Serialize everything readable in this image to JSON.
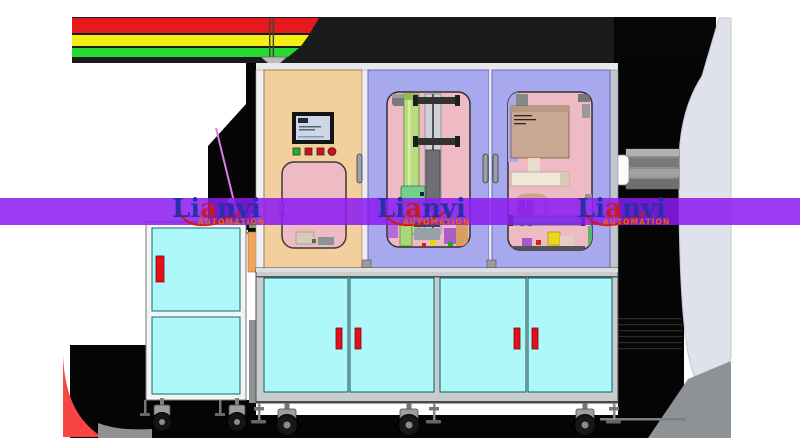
{
  "watermark": {
    "brand_l": "Li",
    "brand_a": "a",
    "brand_rest": "nyi",
    "subtitle": "AUTOMATION",
    "instances": 3
  },
  "signal_stripes": [
    "red",
    "yellow",
    "green"
  ],
  "indicators": [
    "green",
    "red",
    "red",
    "red"
  ],
  "lower_cabinet": {
    "door_count": 4,
    "handle_count": 4
  },
  "left_cabinet": {
    "door_count": 2,
    "handle_count": 1
  },
  "colors": {
    "background": "#ffffff",
    "stripe_red": "#e6191c",
    "stripe_yellow": "#f2ef13",
    "stripe_green": "#27d931",
    "band_dark": "#1b1b1d",
    "band_black": "#060606",
    "shadow_black": "#050505",
    "watermark_purple": "#8b1cf0",
    "logo_blue": "#2730a8",
    "logo_red": "#cc1a1a",
    "logo_orange": "#e8611a",
    "panel_tan": "#f4cf9e",
    "door_purple": "#a8a8ee",
    "window_pink": "#eebac3",
    "door_cyan": "#aef8f9",
    "handle_red": "#e3101b",
    "frame_gray": "#c9ccce",
    "cabinet_white": "#f4f4f4",
    "hmi_screen": "#ccd7e8",
    "indicator_green": "#1db528",
    "indicator_red": "#d31016",
    "belt_green": "#b8dc82",
    "rail_teal": "#4aa9a0",
    "blob_gray": "#dfe2ea",
    "floor_gray": "#8e9296",
    "sail_red": "#f94444"
  }
}
